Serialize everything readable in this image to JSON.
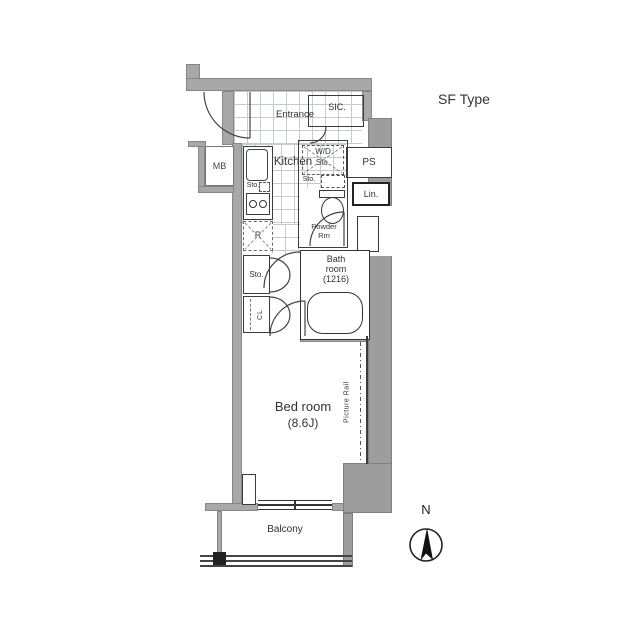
{
  "title": "SF Type",
  "colors": {
    "wall": "#a8a8a8",
    "mass": "#9d9d9d",
    "line": "#3c3c3c",
    "tile": "#c6cacd",
    "text": "#333333"
  },
  "compass": {
    "north_label": "N"
  },
  "labels": {
    "type": "SF Type",
    "entrance": "Entrance",
    "sic": "SIC.",
    "kitchen": "Kitchen",
    "mb": "MB",
    "ps": "PS",
    "lin": "Lin.",
    "wd_sto": {
      "line1": "W/D",
      "line2": "Sto."
    },
    "sink_sto": "Sto.",
    "shelf_sto": "Sto.",
    "fridge": "R",
    "powder": {
      "line1": "Powder",
      "line2": "Rm"
    },
    "bath": {
      "line1": "Bath",
      "line2": "room",
      "line3": "(1216)"
    },
    "closet_sto": "Sto.",
    "closet_cl": "CL",
    "bedroom": {
      "line1": "Bed room",
      "line2": "(8.6J)"
    },
    "picture_rail": "Picture Rail",
    "balcony": "Balcony"
  }
}
